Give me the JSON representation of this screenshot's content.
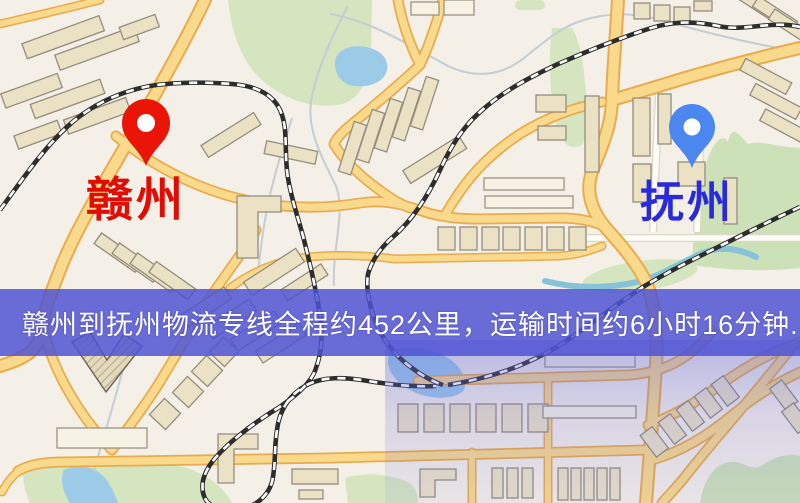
{
  "map": {
    "background_color": "#f4efe7",
    "markers": {
      "origin": {
        "name": "赣州",
        "pin_color": "#ea1407",
        "label_color": "#e00d04"
      },
      "destination": {
        "name": "抚州",
        "pin_color": "#4b87ef",
        "label_color": "#2a2ada"
      }
    }
  },
  "banner": {
    "text": "赣州到抚州物流专线全程约452公里，运输时间约6小时16分钟.",
    "background_color": "#4e52d4",
    "text_color": "#ffffff"
  },
  "route": {
    "from": "赣州",
    "to": "抚州",
    "service": "物流专线",
    "distance": "约452公里",
    "duration": "约6小时16分钟"
  }
}
